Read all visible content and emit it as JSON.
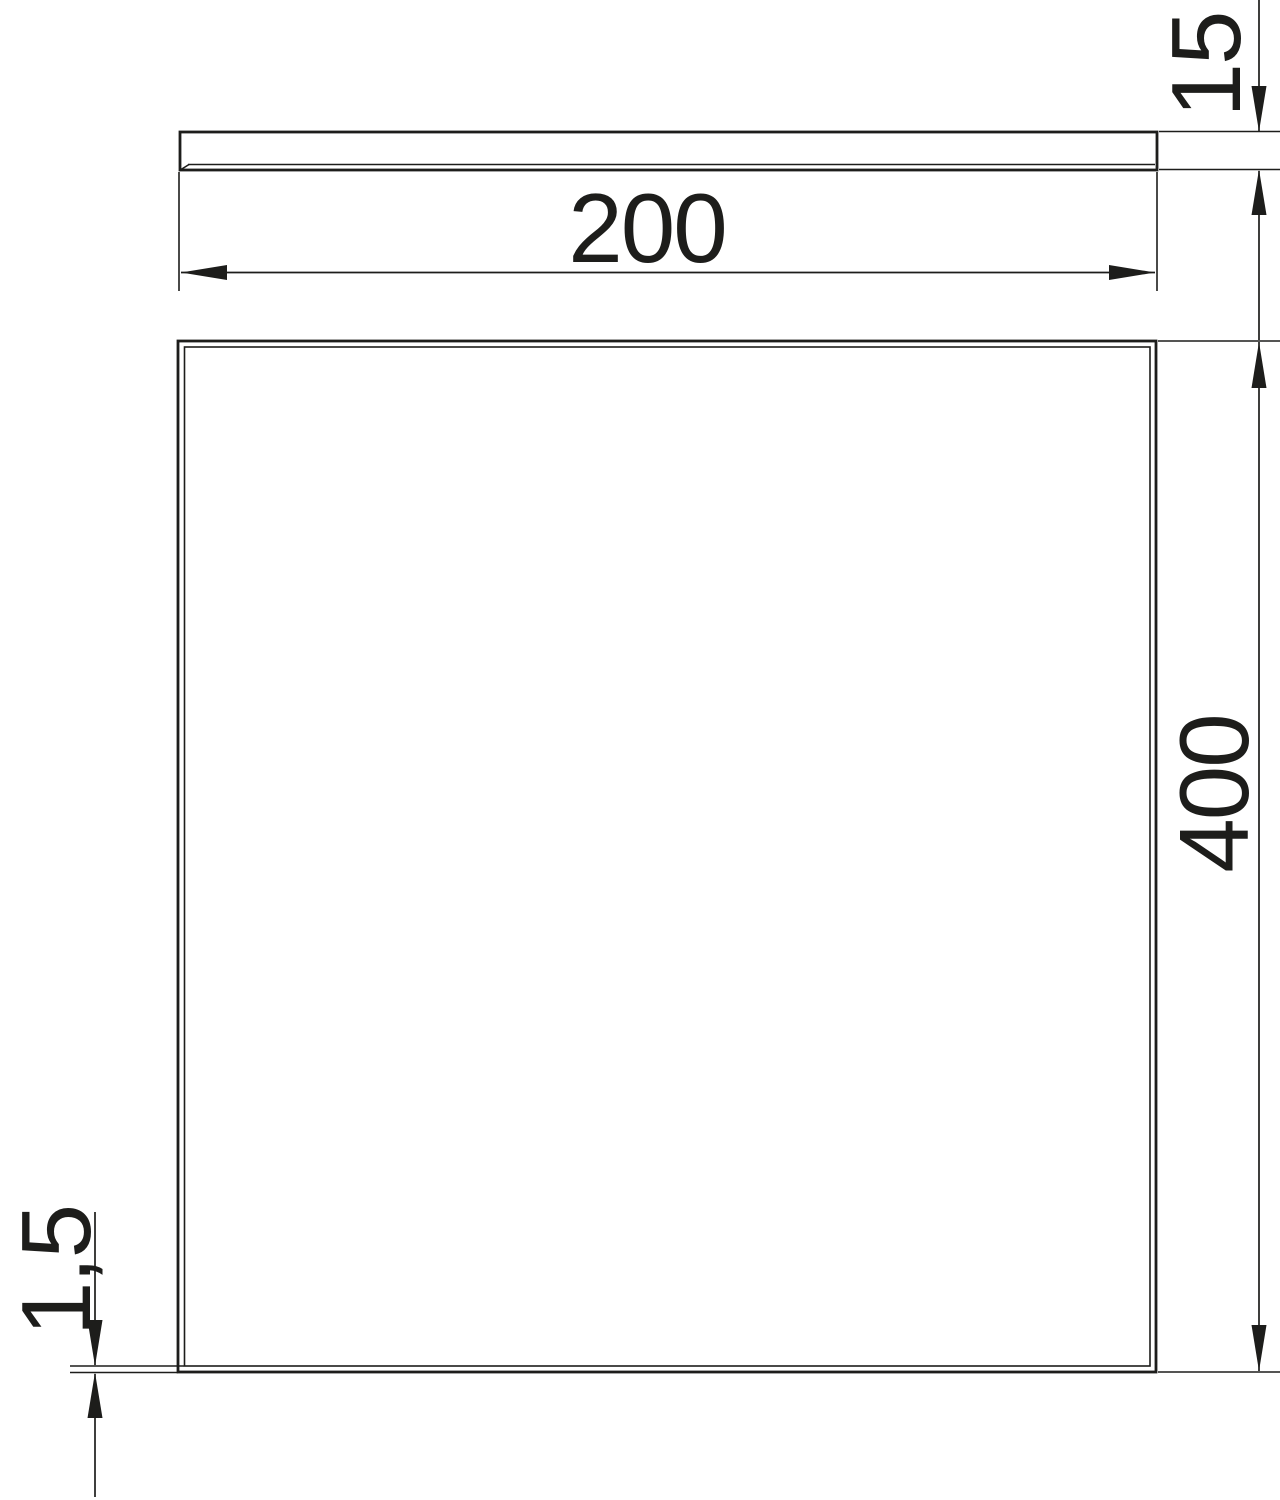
{
  "colors": {
    "background": "#ffffff",
    "line": "#1d1d1b"
  },
  "dimensions": {
    "cover_width": {
      "label": "200"
    },
    "cover_height": {
      "label": "15"
    },
    "cover_length": {
      "label": "400"
    },
    "material_thickness": {
      "label": "1,5"
    }
  }
}
